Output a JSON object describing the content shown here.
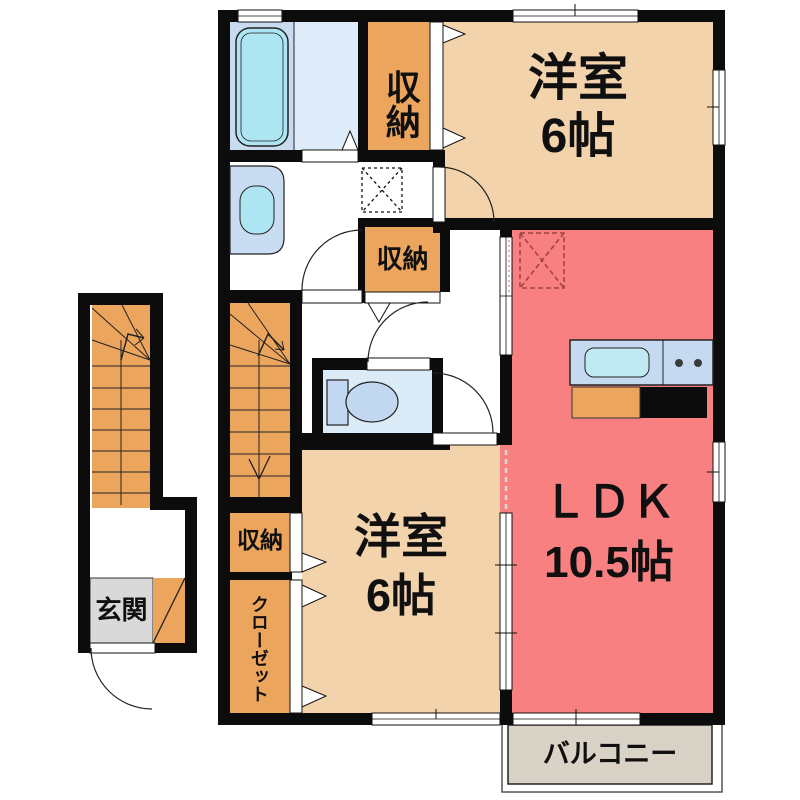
{
  "plan": {
    "rooms": {
      "bedroom_upper": {
        "name": "洋室",
        "size": "6帖"
      },
      "bedroom_lower": {
        "name": "洋室",
        "size": "6帖"
      },
      "ldk": {
        "name": "ＬＤＫ",
        "size": "10.5帖"
      },
      "balcony": {
        "label": "バルコニー"
      },
      "entrance": {
        "label": "玄関"
      },
      "closet": {
        "label": "クローゼット"
      },
      "storage_bath": {
        "label": "収納"
      },
      "storage_hall": {
        "label": "収納"
      },
      "storage_bedroom": {
        "label": "収納"
      }
    },
    "fixtures": {
      "bathtub": "bathtub-icon",
      "washbasin": "washbasin-icon",
      "toilet": "toilet-icon",
      "kitchen": "kitchen-counter-icon",
      "internal_stairs": "internal-staircase",
      "external_stairs": "external-staircase"
    },
    "colors": {
      "wall": "#0c0c0c",
      "bedroom": "#f3d3ac",
      "ldk": "#f88080",
      "storage": "#eca55c",
      "bath": "#c9dcef",
      "washarea": "#deebf8",
      "toilet": "#dcebf8",
      "fixture_blue": "#ade5f2",
      "counter_blue": "#c5d9f0",
      "entrance_tile": "#d9d9d9",
      "balcony": "#d9d2c7"
    }
  }
}
